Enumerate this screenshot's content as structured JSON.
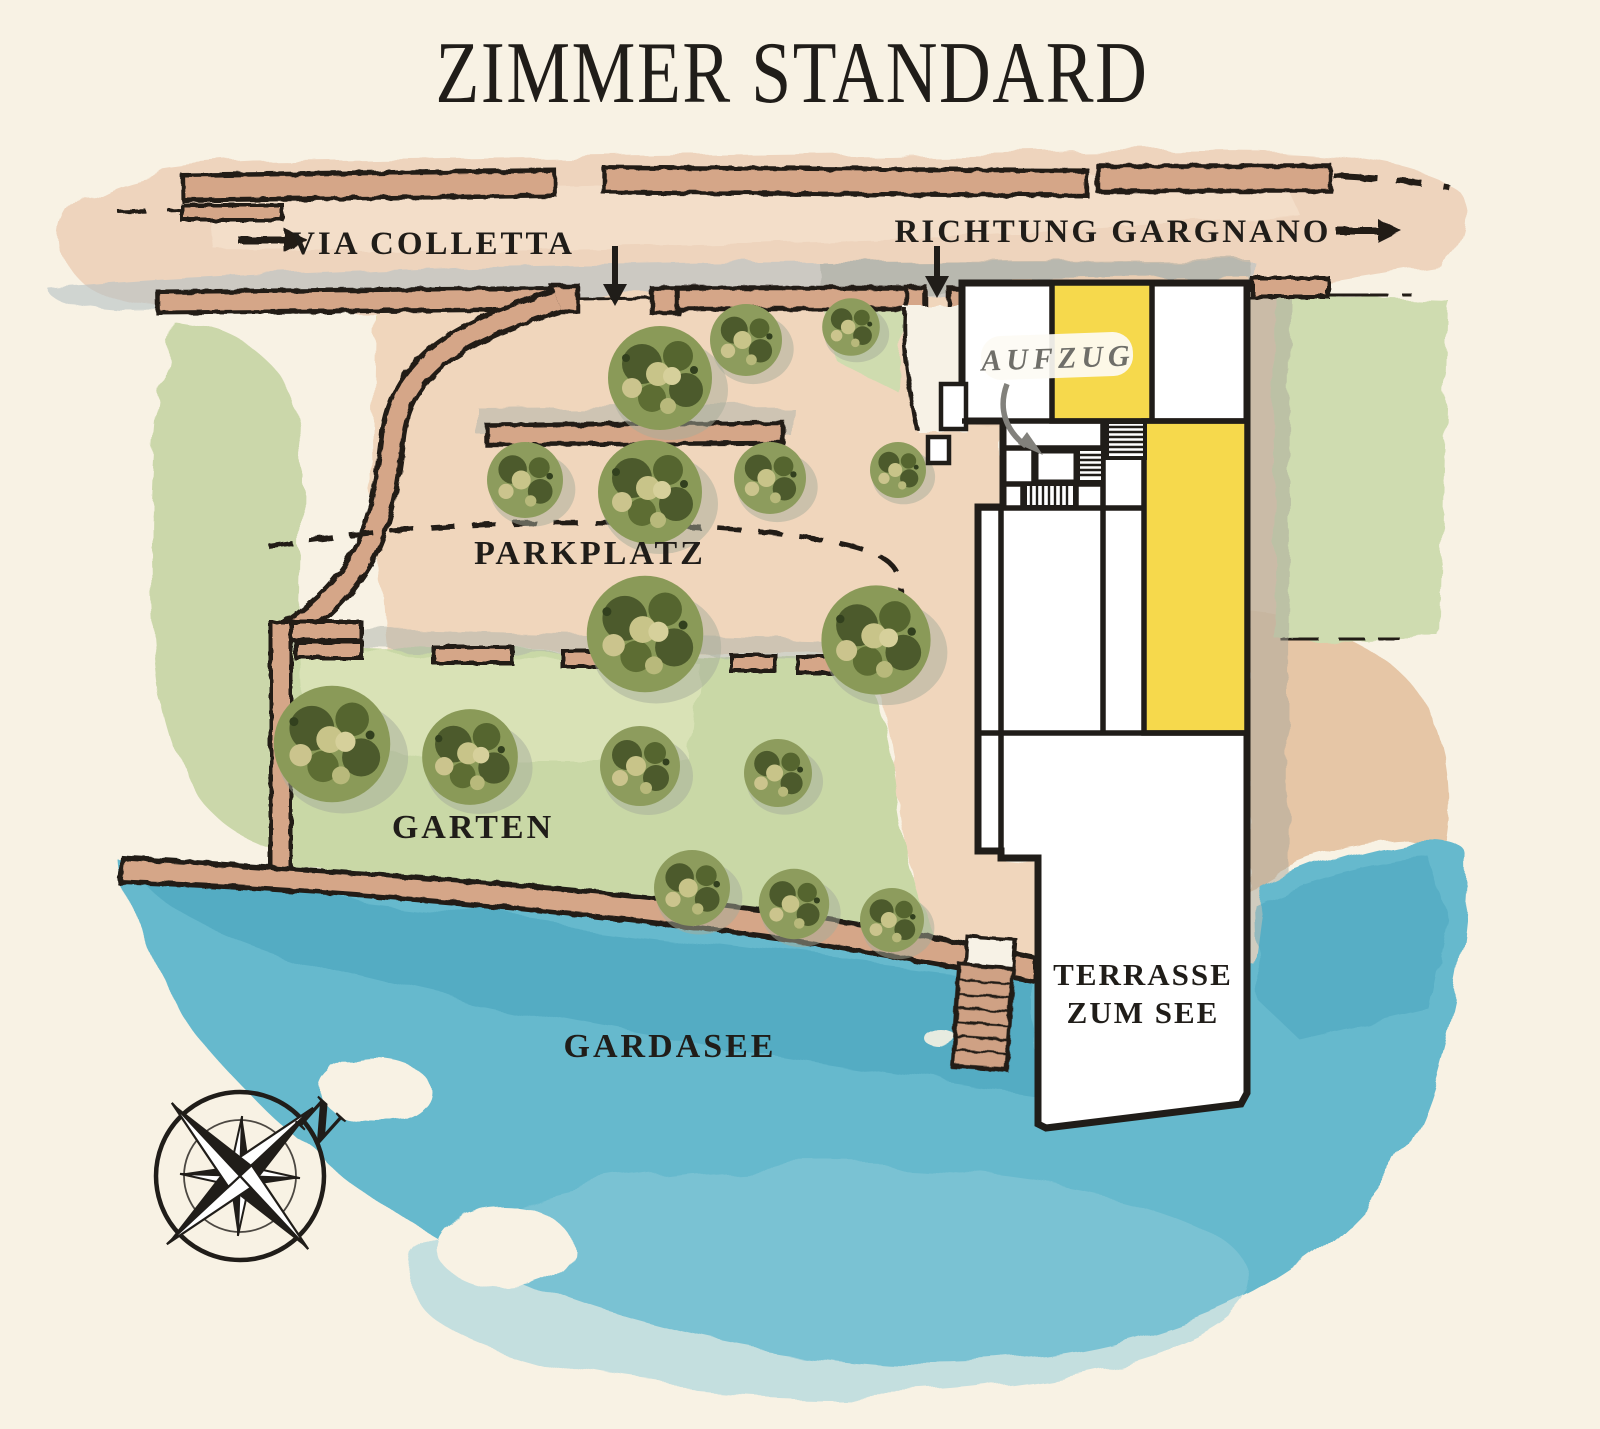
{
  "title": "ZIMMER STANDARD",
  "streets": {
    "via_colletta": "VIA COLLETTA",
    "richtung_gargnano": "RICHTUNG GARGNANO"
  },
  "areas": {
    "parking": "PARKPLATZ",
    "garden": "GARTEN",
    "lake": "GARDASEE",
    "terrace_line1": "TERRASSE",
    "terrace_line2": "ZUM SEE"
  },
  "building": {
    "elevator": "AUFZUG"
  },
  "compass": {
    "north": "N"
  },
  "colors": {
    "paper": "#f8f2e4",
    "ink": "#201d19",
    "room_highlight": "#f6d94c",
    "lake": "#66b9cd",
    "lake_deep": "#47a2bc",
    "lake_light": "#8fcbd9",
    "garden": "#c9d8a6",
    "garden_light": "#dde5bb",
    "road": "#eed4bd",
    "court": "#f0d6bc",
    "wall": "#d5a688",
    "shadow": "#adb3ab",
    "shadow_blue": "#b6c2c6",
    "label_gray": "#6f6e69"
  }
}
